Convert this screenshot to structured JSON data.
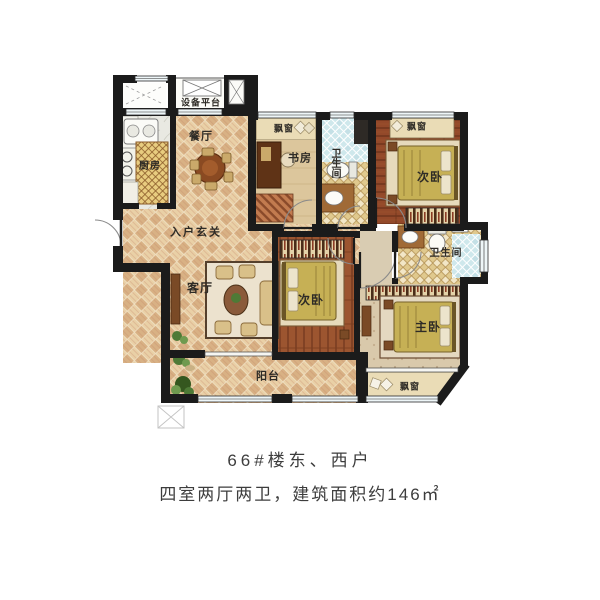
{
  "floorplan": {
    "labels": {
      "equipment_platform": "设备平台",
      "dining_room": "餐厅",
      "kitchen": "厨房",
      "bay_window_study": "飘窗",
      "study": "书房",
      "bathroom_1": "卫生间",
      "bay_window_bedroom_north": "飘窗",
      "bedroom_north": "次卧",
      "entry_foyer": "入户玄关",
      "living_room": "客厅",
      "bedroom_middle": "次卧",
      "bathroom_master": "卫生间",
      "master_bedroom": "主卧",
      "balcony": "阳台",
      "bay_window_master": "飘窗"
    },
    "caption": {
      "line1": "66#楼东、西户",
      "line2": "四室两厅两卫，建筑面积约146㎡"
    },
    "colors": {
      "wall": "#1b1b1b",
      "tile_light": "#e9d0a6",
      "tile_dark": "#d8b184",
      "wood_dark": "#93492a",
      "bed": "#c6b055",
      "bath_tile": "#cfe8ec",
      "bath_floor": "#f2e6c6",
      "window_glass": "#eef6f8",
      "caption_text": "#3d3d3d"
    },
    "icons": {
      "window_cross": "boxed X window/shaft marker",
      "door_arc": "quarter-circle door swing",
      "plant": "green plant cluster"
    }
  }
}
